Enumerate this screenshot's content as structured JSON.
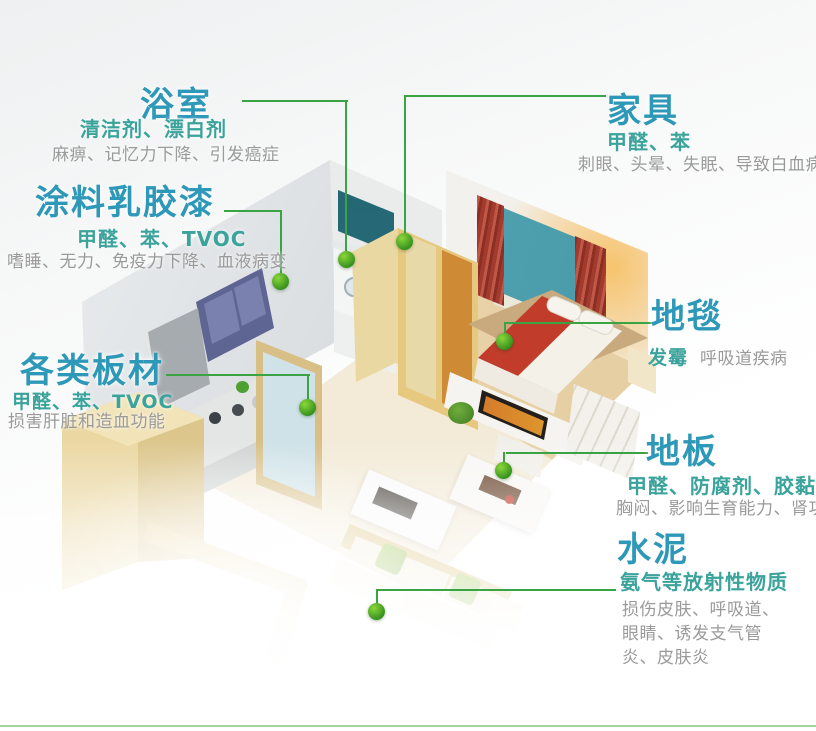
{
  "colors": {
    "c-title": "#2e98b8",
    "c-sub": "#3aa39b",
    "c-desc": "#9a9a9a",
    "c-line": "#3aa344",
    "c-dot1": "#8bd63a",
    "c-dot2": "#2c8a1a"
  },
  "callouts": {
    "bathroom": {
      "title": "浴室",
      "subtitle": "清洁剂、漂白剂",
      "desc": "麻痹、记忆力下降、引发癌症"
    },
    "paint": {
      "title": "涂料乳胶漆",
      "subtitle": "甲醛、苯、TVOC",
      "desc": "嗜睡、无力、免疫力下降、血液病变"
    },
    "boards": {
      "title": "各类板材",
      "subtitle": "甲醛、苯、TVOC",
      "desc": "损害肝脏和造血功能"
    },
    "furniture": {
      "title": "家具",
      "subtitle": "甲醛、苯",
      "desc": "刺眼、头晕、失眠、导致白血病"
    },
    "carpet": {
      "title": "地毯",
      "subtitle": "发霉",
      "desc": "呼吸道疾病"
    },
    "floor": {
      "title": "地板",
      "subtitle": "甲醛、防腐剂、胶黏剂",
      "desc": "胸闷、影响生育能力、肾功能"
    },
    "cement": {
      "title": "水泥",
      "subtitle": "氨气等放射性物质",
      "desc": "损伤皮肤、呼吸道、眼睛、诱发支气管炎、皮肤炎"
    }
  }
}
